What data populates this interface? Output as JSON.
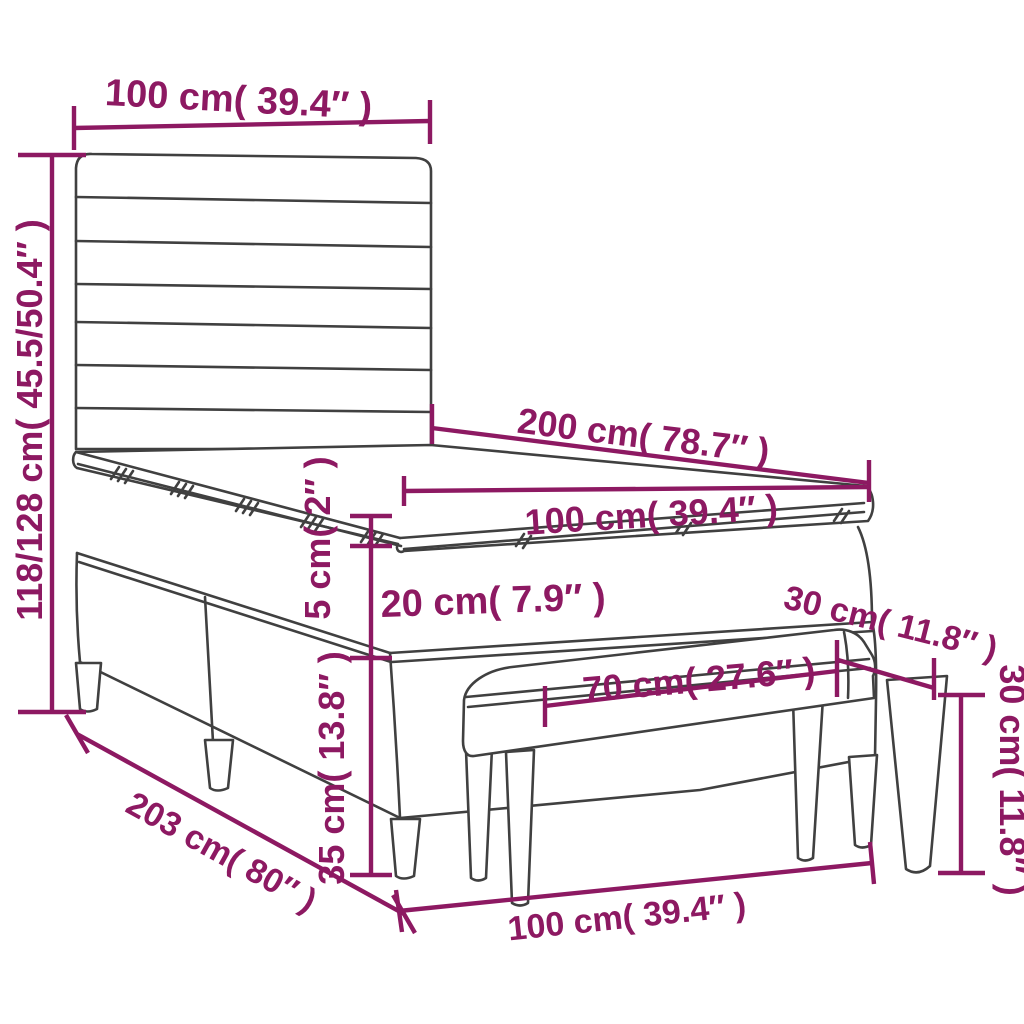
{
  "diagram": {
    "kind": "product-dimension-line-drawing",
    "subject": "box spring bed with striped headboard, mattress with topper, and bench",
    "colors": {
      "dimension_annotations": "#8d1962",
      "line_art": "#404040",
      "background": "#ffffff"
    }
  },
  "labels": {
    "headboard_width": "100 cm( 39.4″ )",
    "bed_height": "118/128 cm( 45.5/50.4″ )",
    "bed_length": "200 cm( 78.7″ )",
    "mattress_width": "100 cm( 39.4″ )",
    "topper_thickness": "5 cm( 2″ )",
    "boxspring_thickness": "20 cm( 7.9″ )",
    "bench_depth": "30 cm( 11.8″ )",
    "bench_seat_width": "70 cm( 27.6″ )",
    "bench_height": "30 cm( 11.8″ )",
    "bed_leg_height": "35 cm( 13.8″ )",
    "bed_base_length": "203 cm( 80″ )",
    "bench_overall_width": "100 cm( 39.4″ )"
  }
}
